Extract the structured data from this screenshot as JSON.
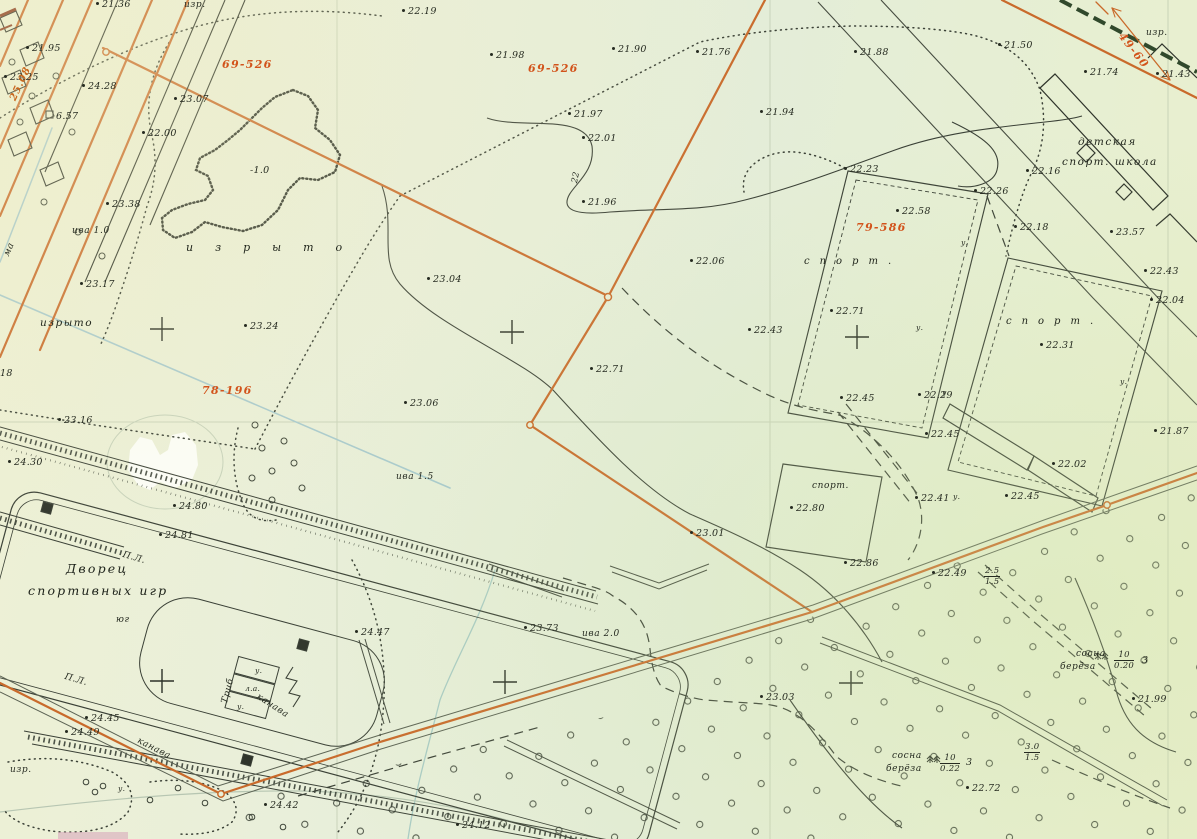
{
  "map": {
    "description": "scanned topographic site plan",
    "colors": {
      "paper": "#e8efd8",
      "boundary_orange": "#c96a2b",
      "parcel_label_orange": "#d2531b",
      "ink_black": "#3a4036",
      "water_blue": "#a7c9ce",
      "dark_green_line": "#31492c"
    },
    "labels": [
      {
        "text": "изр.",
        "x": 184,
        "y": 0,
        "cls": "name-sm",
        "n": "abbr-izr"
      },
      {
        "text": "21.36",
        "x": 96,
        "y": 0,
        "cls": "elev"
      },
      {
        "text": "22.19",
        "x": 402,
        "y": 7,
        "cls": "elev"
      },
      {
        "text": "21.98",
        "x": 490,
        "y": 51,
        "cls": "elev"
      },
      {
        "text": "69-526",
        "x": 222,
        "y": 58,
        "cls": "parcel"
      },
      {
        "text": "69-526",
        "x": 528,
        "y": 62,
        "cls": "parcel"
      },
      {
        "text": "21.90",
        "x": 612,
        "y": 45,
        "cls": "elev"
      },
      {
        "text": "21.76",
        "x": 696,
        "y": 48,
        "cls": "elev"
      },
      {
        "text": "21.88",
        "x": 854,
        "y": 48,
        "cls": "elev"
      },
      {
        "text": "21.50",
        "x": 998,
        "y": 41,
        "cls": "elev"
      },
      {
        "text": "изр.",
        "x": 1146,
        "y": 28,
        "cls": "name-sm",
        "n": "abbr-izr"
      },
      {
        "text": "49-60",
        "x": 1126,
        "y": 30,
        "cls": "parcel",
        "rot": 52
      },
      {
        "text": "21.74",
        "x": 1084,
        "y": 68,
        "cls": "elev"
      },
      {
        "text": "21.43",
        "x": 1156,
        "y": 70,
        "cls": "elev"
      },
      {
        "text": "детская",
        "x": 1078,
        "y": 136,
        "cls": "name",
        "n": "school-label-line1"
      },
      {
        "text": "спорт. школа",
        "x": 1062,
        "y": 156,
        "cls": "name",
        "n": "school-label-line2"
      },
      {
        "text": "23.07",
        "x": 174,
        "y": 95,
        "cls": "elev"
      },
      {
        "text": "24.28",
        "x": 82,
        "y": 82,
        "cls": "elev"
      },
      {
        "text": "21.95",
        "x": 26,
        "y": 44,
        "cls": "elev"
      },
      {
        "text": "23.25",
        "x": 4,
        "y": 73,
        "cls": "elev"
      },
      {
        "text": "6.57",
        "x": 56,
        "y": 111,
        "cls": "plain",
        "n": "benchmark-label"
      },
      {
        "text": "25.08",
        "x": 8,
        "y": 98,
        "cls": "omark",
        "rot": -65
      },
      {
        "text": "22.00",
        "x": 142,
        "y": 129,
        "cls": "elev"
      },
      {
        "text": "21.97",
        "x": 568,
        "y": 110,
        "cls": "elev"
      },
      {
        "text": "22.01",
        "x": 582,
        "y": 134,
        "cls": "elev"
      },
      {
        "text": "21.94",
        "x": 760,
        "y": 108,
        "cls": "elev"
      },
      {
        "text": "21.96",
        "x": 582,
        "y": 198,
        "cls": "elev"
      },
      {
        "text": "22",
        "x": 570,
        "y": 182,
        "cls": "contour",
        "rot": -78,
        "n": "contour-elevation-label"
      },
      {
        "text": "-1.0",
        "x": 250,
        "y": 165,
        "cls": "plain",
        "n": "depression-depth-label"
      },
      {
        "text": "23.38",
        "x": 106,
        "y": 200,
        "cls": "elev"
      },
      {
        "text": "ива 1.0",
        "x": 72,
        "y": 226,
        "cls": "name-sm",
        "n": "vegetation-willow-label"
      },
      {
        "text": "изрыто",
        "x": 186,
        "y": 241,
        "cls": "spread",
        "n": "izryto-label"
      },
      {
        "text": "23.17",
        "x": 80,
        "y": 280,
        "cls": "elev"
      },
      {
        "text": "изрыто",
        "x": 40,
        "y": 317,
        "cls": "name",
        "n": "izryto-label"
      },
      {
        "text": "23.24",
        "x": 244,
        "y": 322,
        "cls": "elev"
      },
      {
        "text": "78-196",
        "x": 202,
        "y": 384,
        "cls": "parcel"
      },
      {
        "text": "23.16",
        "x": 58,
        "y": 416,
        "cls": "elev"
      },
      {
        "text": "18",
        "x": 0,
        "y": 368,
        "cls": "plain"
      },
      {
        "text": "24.30",
        "x": 8,
        "y": 458,
        "cls": "elev"
      },
      {
        "text": "23.04",
        "x": 427,
        "y": 275,
        "cls": "elev"
      },
      {
        "text": "22.06",
        "x": 690,
        "y": 257,
        "cls": "elev"
      },
      {
        "text": "23.06",
        "x": 404,
        "y": 399,
        "cls": "elev"
      },
      {
        "text": "22.71",
        "x": 590,
        "y": 365,
        "cls": "elev"
      },
      {
        "text": "22.71",
        "x": 830,
        "y": 307,
        "cls": "elev"
      },
      {
        "text": "22.43",
        "x": 748,
        "y": 326,
        "cls": "elev"
      },
      {
        "text": "22.23",
        "x": 844,
        "y": 165,
        "cls": "elev"
      },
      {
        "text": "22.26",
        "x": 974,
        "y": 187,
        "cls": "elev"
      },
      {
        "text": "22.58",
        "x": 896,
        "y": 207,
        "cls": "elev"
      },
      {
        "text": "79-586",
        "x": 856,
        "y": 221,
        "cls": "parcel"
      },
      {
        "text": "22.16",
        "x": 1026,
        "y": 167,
        "cls": "elev"
      },
      {
        "text": "22.18",
        "x": 1014,
        "y": 223,
        "cls": "elev"
      },
      {
        "text": "23.57",
        "x": 1110,
        "y": 228,
        "cls": "elev"
      },
      {
        "text": "спорт.",
        "x": 804,
        "y": 256,
        "cls": "spread2",
        "n": "sport-ground-label"
      },
      {
        "text": "спорт.",
        "x": 1006,
        "y": 316,
        "cls": "spread2",
        "n": "sport-ground-label"
      },
      {
        "text": "22.31",
        "x": 1040,
        "y": 341,
        "cls": "elev"
      },
      {
        "text": "22.04",
        "x": 1150,
        "y": 296,
        "cls": "elev"
      },
      {
        "text": "22.43",
        "x": 1144,
        "y": 267,
        "cls": "elev"
      },
      {
        "text": "21.87",
        "x": 1154,
        "y": 427,
        "cls": "elev"
      },
      {
        "text": "22.29",
        "x": 918,
        "y": 391,
        "cls": "elev"
      },
      {
        "text": "22.45",
        "x": 925,
        "y": 430,
        "cls": "elev"
      },
      {
        "text": "22.02",
        "x": 1052,
        "y": 460,
        "cls": "elev"
      },
      {
        "text": "22.41",
        "x": 915,
        "y": 494,
        "cls": "elev"
      },
      {
        "text": "22.45",
        "x": 1005,
        "y": 492,
        "cls": "elev"
      },
      {
        "text": "22.45",
        "x": 840,
        "y": 394,
        "cls": "elev"
      },
      {
        "text": "спорт.",
        "x": 812,
        "y": 481,
        "cls": "name-sm",
        "n": "sport-ground-label"
      },
      {
        "text": "22.80",
        "x": 790,
        "y": 504,
        "cls": "elev"
      },
      {
        "text": "22.86",
        "x": 844,
        "y": 559,
        "cls": "elev"
      },
      {
        "text": "23.01",
        "x": 690,
        "y": 529,
        "cls": "elev"
      },
      {
        "text": "22.49",
        "x": 932,
        "y": 569,
        "cls": "elev"
      },
      {
        "frac": {
          "top": "2.5",
          "bot": "1.5"
        },
        "x": 984,
        "y": 566,
        "cls": "fracl",
        "n": "clearing-ratio-label"
      },
      {
        "text": "ива 1.5",
        "x": 396,
        "y": 472,
        "cls": "name-sm",
        "n": "vegetation-willow-label"
      },
      {
        "text": "23.73",
        "x": 524,
        "y": 624,
        "cls": "elev"
      },
      {
        "text": "ива 2.0",
        "x": 582,
        "y": 629,
        "cls": "name-sm",
        "n": "vegetation-willow-label"
      },
      {
        "text": "23.03",
        "x": 760,
        "y": 693,
        "cls": "elev"
      },
      {
        "text": "сосна",
        "x": 1076,
        "y": 649,
        "cls": "name-sm",
        "n": "vegetation-pine-label"
      },
      {
        "text": "берёза",
        "x": 1060,
        "y": 662,
        "cls": "name-sm",
        "n": "vegetation-birch-label"
      },
      {
        "frac": {
          "top": "10",
          "bot": "0.20"
        },
        "x": 1114,
        "y": 650,
        "cls": "fracl",
        "n": "stand-metrics-label"
      },
      {
        "text": "3",
        "x": 1142,
        "y": 655,
        "cls": "plain"
      },
      {
        "text": "21.99",
        "x": 1132,
        "y": 695,
        "cls": "elev"
      },
      {
        "frac": {
          "top": "3.0",
          "bot": "1.5"
        },
        "x": 1024,
        "y": 742,
        "cls": "fracl",
        "n": "clearing-ratio-label"
      },
      {
        "text": "сосна",
        "x": 892,
        "y": 751,
        "cls": "name-sm",
        "n": "vegetation-pine-label"
      },
      {
        "text": "берёза",
        "x": 886,
        "y": 764,
        "cls": "name-sm",
        "n": "vegetation-birch-label"
      },
      {
        "frac": {
          "top": "10",
          "bot": "0.22"
        },
        "x": 940,
        "y": 753,
        "cls": "fracl",
        "n": "stand-metrics-label"
      },
      {
        "text": "3",
        "x": 966,
        "y": 757,
        "cls": "plain"
      },
      {
        "text": "22.72",
        "x": 966,
        "y": 784,
        "cls": "elev"
      },
      {
        "text": "24.12",
        "x": 456,
        "y": 821,
        "cls": "elev"
      },
      {
        "text": "24.42",
        "x": 264,
        "y": 801,
        "cls": "elev"
      },
      {
        "text": "Дворец",
        "x": 66,
        "y": 561,
        "cls": "name-lg",
        "n": "palace-of-sport-games-label"
      },
      {
        "text": "спортивных игр",
        "x": 28,
        "y": 583,
        "cls": "name-lg",
        "n": "palace-of-sport-games-label"
      },
      {
        "text": "юг",
        "x": 116,
        "y": 615,
        "cls": "name-sm"
      },
      {
        "text": "П.Л.",
        "x": 124,
        "y": 550,
        "cls": "name-sm",
        "rot": 16
      },
      {
        "text": "П.Л.",
        "x": 66,
        "y": 672,
        "cls": "name-sm",
        "rot": 16
      },
      {
        "text": "Триб",
        "x": 220,
        "y": 702,
        "cls": "name-sm",
        "rot": -75,
        "n": "stands-label"
      },
      {
        "text": "у.",
        "x": 255,
        "y": 666,
        "cls": "name-xs"
      },
      {
        "text": "л.а.",
        "x": 245,
        "y": 684,
        "cls": "name-xs"
      },
      {
        "text": "у.",
        "x": 237,
        "y": 702,
        "cls": "name-xs"
      },
      {
        "text": "канава",
        "x": 260,
        "y": 692,
        "cls": "name-sm",
        "rot": 33,
        "n": "ditch-label"
      },
      {
        "text": "канава",
        "x": 140,
        "y": 736,
        "cls": "name-sm",
        "rot": 27,
        "n": "ditch-label"
      },
      {
        "text": "изр.",
        "x": 10,
        "y": 765,
        "cls": "name-sm",
        "n": "abbr-izr"
      },
      {
        "text": "24.80",
        "x": 173,
        "y": 502,
        "cls": "elev"
      },
      {
        "text": "24.81",
        "x": 159,
        "y": 531,
        "cls": "elev"
      },
      {
        "text": "24.47",
        "x": 355,
        "y": 628,
        "cls": "elev"
      },
      {
        "text": "24.45",
        "x": 85,
        "y": 714,
        "cls": "elev"
      },
      {
        "text": "24.49",
        "x": 65,
        "y": 728,
        "cls": "elev"
      },
      {
        "text": "ма",
        "x": 2,
        "y": 254,
        "cls": "name-sm",
        "rot": -67,
        "n": "street-name-fragment"
      },
      {
        "text": "у.",
        "x": 961,
        "y": 238,
        "cls": "name-xs"
      },
      {
        "text": "у.",
        "x": 916,
        "y": 323,
        "cls": "name-xs"
      },
      {
        "text": "у.",
        "x": 942,
        "y": 388,
        "cls": "name-xs"
      },
      {
        "text": "у.",
        "x": 1120,
        "y": 377,
        "cls": "name-xs"
      },
      {
        "text": "у.",
        "x": 953,
        "y": 492,
        "cls": "name-xs"
      },
      {
        "text": "у.",
        "x": 118,
        "y": 784,
        "cls": "name-xs"
      }
    ]
  }
}
